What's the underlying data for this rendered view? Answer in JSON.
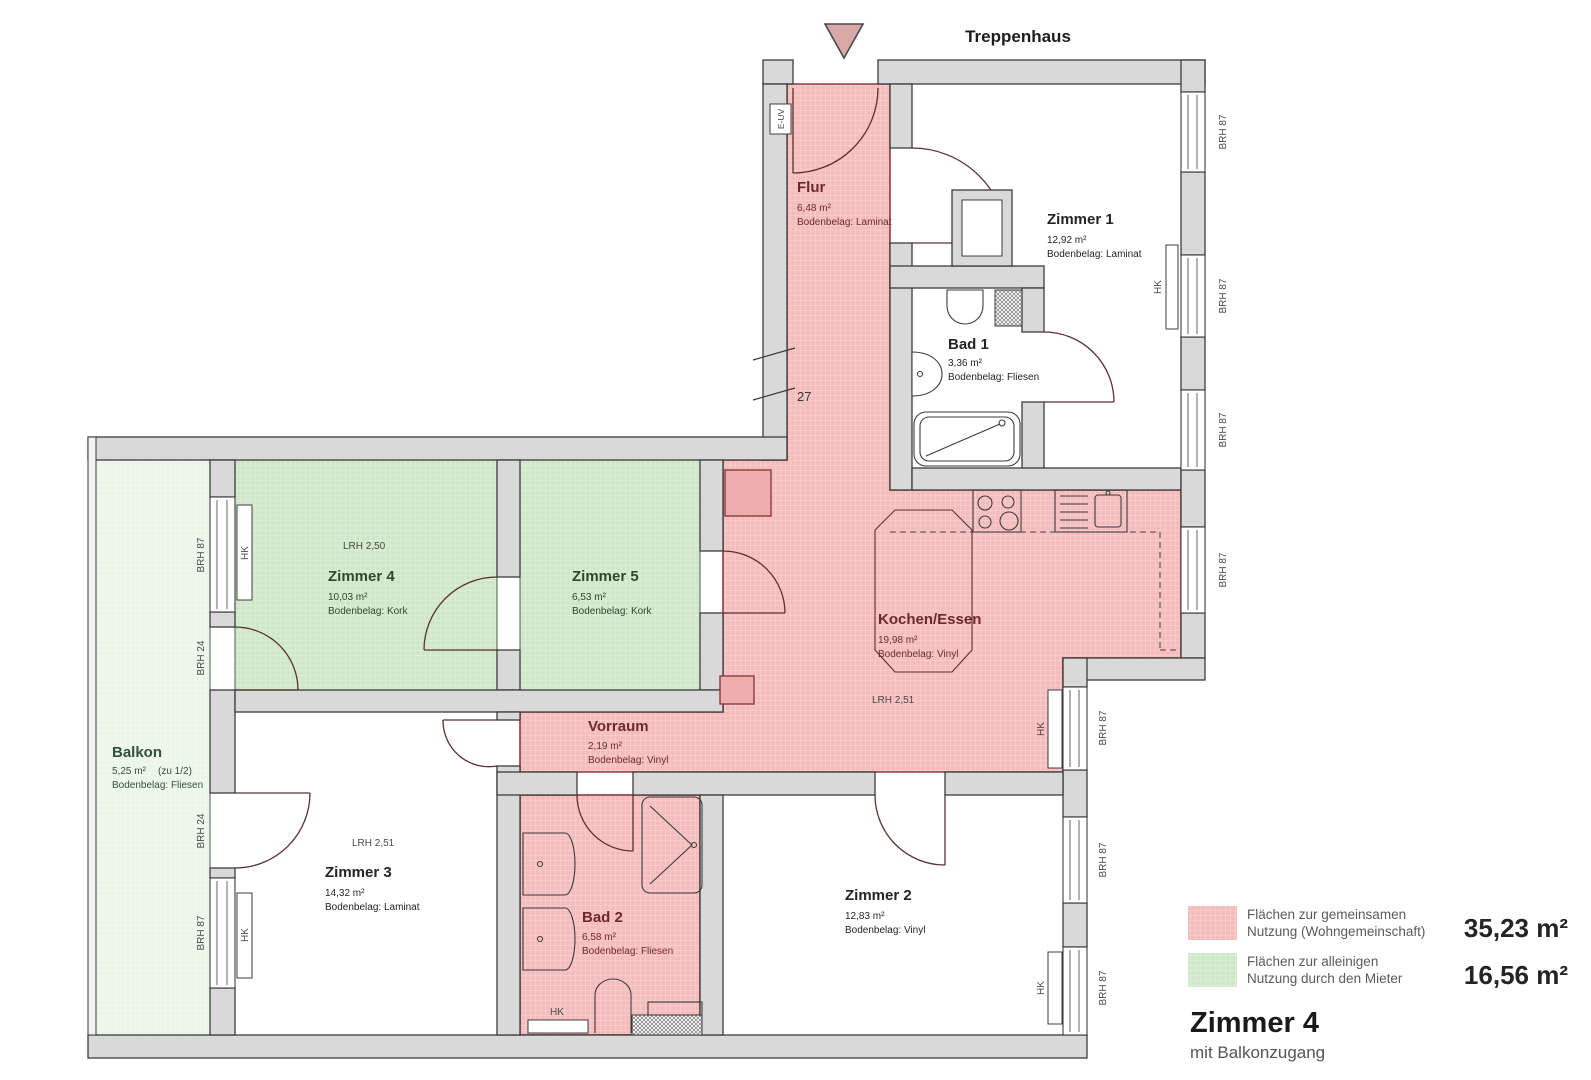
{
  "header": {
    "staircase": "Treppenhaus"
  },
  "rooms": {
    "flur": {
      "name": "Flur",
      "area": "6,48 m²",
      "floor": "Bodenbelag: Laminat"
    },
    "zimmer1": {
      "name": "Zimmer 1",
      "area": "12,92 m²",
      "floor": "Bodenbelag: Laminat"
    },
    "bad1": {
      "name": "Bad 1",
      "area": "3,36 m²",
      "floor": "Bodenbelag: Fliesen"
    },
    "zimmer4": {
      "name": "Zimmer 4",
      "area": "10,03 m²",
      "floor": "Bodenbelag: Kork",
      "lrh": "LRH 2,50"
    },
    "zimmer5": {
      "name": "Zimmer 5",
      "area": "6,53 m²",
      "floor": "Bodenbelag: Kork"
    },
    "kochen": {
      "name": "Kochen/Essen",
      "area": "19,98 m²",
      "floor": "Bodenbelag: Vinyl",
      "lrh": "LRH 2,51"
    },
    "balkon": {
      "name": "Balkon",
      "area": "5,25 m²",
      "share": "(zu 1/2)",
      "floor": "Bodenbelag: Fliesen"
    },
    "zimmer3": {
      "name": "Zimmer 3",
      "area": "14,32 m²",
      "floor": "Bodenbelag: Laminat",
      "lrh": "LRH 2,51"
    },
    "vorraum": {
      "name": "Vorraum",
      "area": "2,19 m²",
      "floor": "Bodenbelag: Vinyl"
    },
    "bad2": {
      "name": "Bad 2",
      "area": "6,58 m²",
      "floor": "Bodenbelag: Fliesen"
    },
    "zimmer2": {
      "name": "Zimmer 2",
      "area": "12,83 m²",
      "floor": "Bodenbelag: Vinyl"
    }
  },
  "annotations": {
    "brh87": "BRH 87",
    "brh24": "BRH 24",
    "hk": "HK",
    "euv": "E-UV",
    "dim27": "27"
  },
  "legend": {
    "common": {
      "line1": "Flächen zur gemeinsamen",
      "line2": "Nutzung (Wohngemeinschaft)",
      "value": "35,23 m²"
    },
    "exclusive": {
      "line1": "Flächen zur alleinigen",
      "line2": "Nutzung durch den Mieter",
      "value": "16,56 m²"
    }
  },
  "title_block": {
    "title": "Zimmer 4",
    "subtitle": "mit Balkonzugang"
  },
  "colors": {
    "common_fill": "#f4bcbc",
    "exclusive_fill": "#cfe8ca",
    "balcony_fill": "#eaf6e8",
    "wall_fill": "#d9d9d9",
    "common_stroke": "#8c3b3b"
  }
}
